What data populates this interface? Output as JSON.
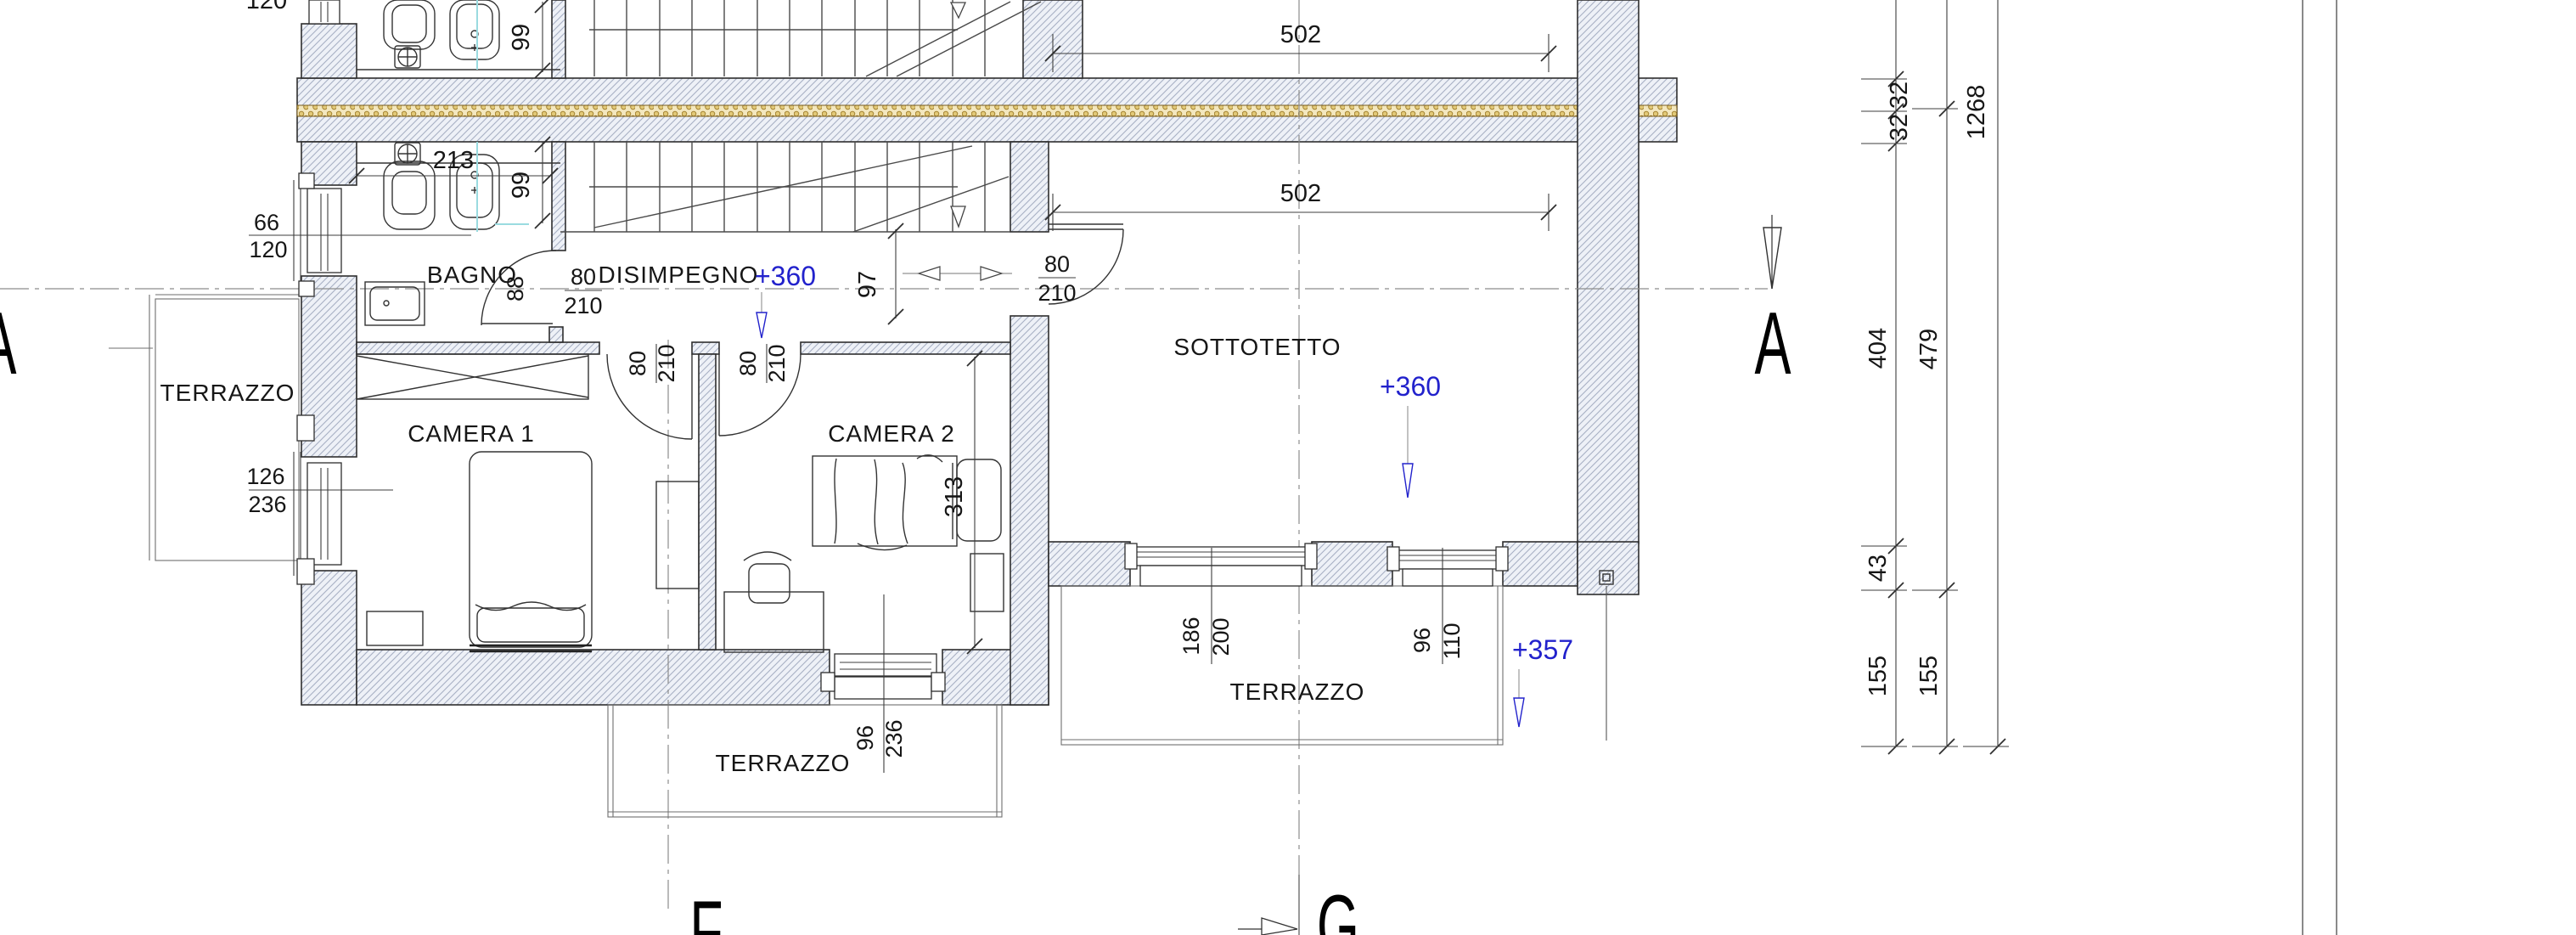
{
  "plan": {
    "rooms": {
      "bagno": "BAGNO",
      "disimpegno": "DISIMPEGNO",
      "camera1": "CAMERA 1",
      "camera2": "CAMERA 2",
      "sottotetto": "SOTTOTETTO",
      "terrazzo_left": "TERRAZZO",
      "terrazzo_mid": "TERRAZZO",
      "terrazzo_right": "TERRAZZO"
    },
    "elevations": {
      "disimpegno": "+360",
      "sottotetto": "+360",
      "terrazzo_right": "+357"
    },
    "axes": {
      "a_left": "A",
      "a_right": "A",
      "f": "F",
      "g": "G"
    },
    "dims": {
      "room_top_width": "502",
      "sottotetto_width": "502",
      "bagno_upper_depth": "99",
      "bagno_lower_depth": "99",
      "bagno_fixture_run": "213",
      "top_partial": "120",
      "bagno_window_w": "66",
      "bagno_window_h": "120",
      "camera1_window_w": "126",
      "camera1_window_h": "236",
      "bagno_door": "88",
      "hall_door_w": "80",
      "hall_door_h": "210",
      "hall_width": "97",
      "camera1_door_w": "80",
      "camera1_door_h": "210",
      "camera2_door_w": "80",
      "camera2_door_h": "210",
      "sottotetto_door_w": "80",
      "sottotetto_door_h": "210",
      "camera2_depth": "313",
      "camera2_window_w": "96",
      "camera2_window_h": "236",
      "terrazzo_window1_w": "186",
      "terrazzo_window1_h": "200",
      "terrazzo_window2_w": "96",
      "terrazzo_window2_h": "110",
      "chain_32a": "32",
      "chain_32b": "32",
      "chain_total": "1268",
      "chain_404": "404",
      "chain_479": "479",
      "chain_43": "43",
      "chain_155a": "155",
      "chain_155b": "155"
    },
    "colors": {
      "elevation_blue": "#2222cc",
      "insulation_fill": "#f3e7be",
      "insulation_dot": "#9c7a26",
      "wall_hatch_line": "#a7b0c4"
    }
  }
}
